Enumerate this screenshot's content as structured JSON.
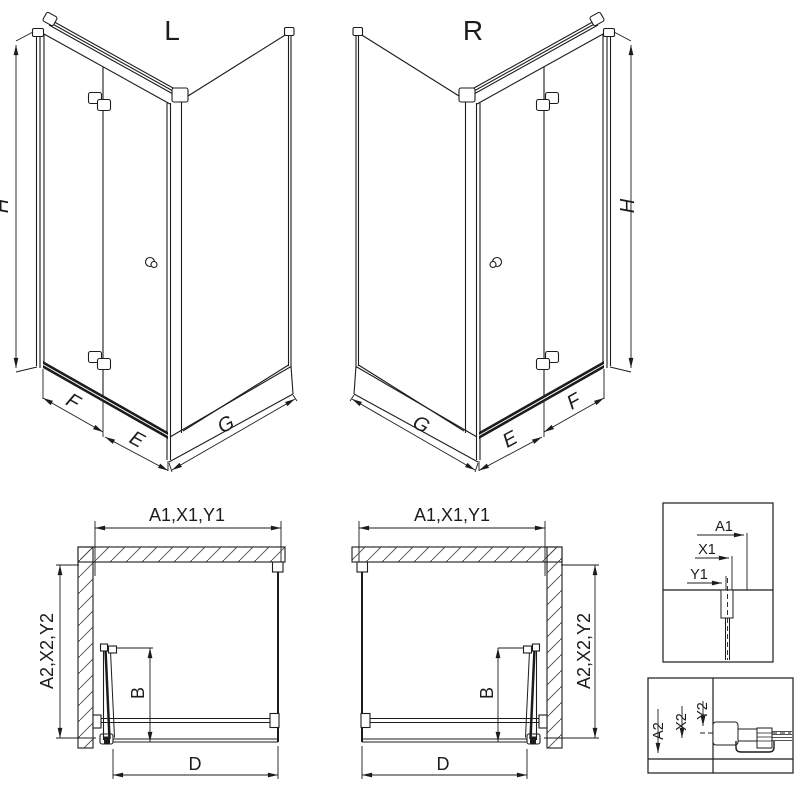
{
  "page": {
    "background": "#ffffff",
    "line_color": "#1c1c1c"
  },
  "iso_left": {
    "title": "L",
    "height_dim": "H",
    "door_panel_dim": "F",
    "door_entry_dim": "E",
    "side_panel_dim": "G"
  },
  "iso_right": {
    "title": "R",
    "height_dim": "H",
    "door_panel_dim": "F",
    "door_entry_dim": "E",
    "side_panel_dim": "G"
  },
  "plan_left": {
    "top_dim": "A1,X1,Y1",
    "side_dim": "A2,X2,Y2",
    "door_fold_dim": "B",
    "bottom_dim": "D"
  },
  "plan_right": {
    "top_dim": "A1,X1,Y1",
    "side_dim": "A2,X2,Y2",
    "door_fold_dim": "B",
    "bottom_dim": "D"
  },
  "detail_top": {
    "a1": "A1",
    "x1": "X1",
    "y1": "Y1"
  },
  "detail_bottom": {
    "a2": "A2",
    "x2": "X2",
    "y2": "Y2"
  }
}
